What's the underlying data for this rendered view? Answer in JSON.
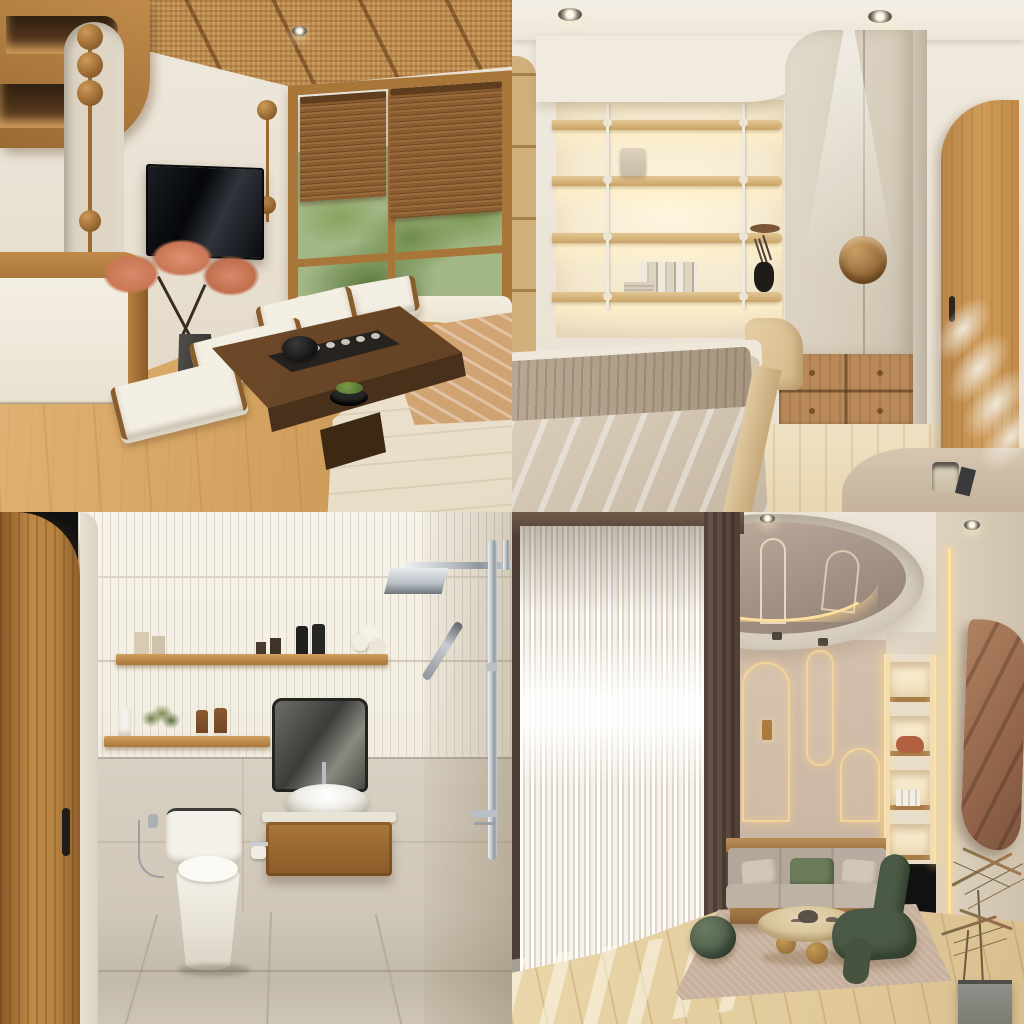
{
  "image": {
    "kind": "interior-design-render-collage",
    "grid": "2x2",
    "style": "Japandi / warm minimalist interiors, beige and wood palette",
    "text_visible": "none"
  },
  "panels": [
    {
      "id": "living-room",
      "position": "top-left",
      "room_type": "Japanese-style living room",
      "description": "Tatami-style tea lounge with rattan ceiling, wall-mounted TV, bamboo blinds over a garden window, low walnut tea table with tea set, floor cushions, cherry-blossom bonsai and white daybed",
      "objects": [
        "rattan ceiling with wood beams",
        "recessed spotlight",
        "wooden wall shelf with warm lighting",
        "white drawer cabinet with wood trim",
        "arched wall niche",
        "wooden bead ornaments",
        "wall-mounted TV",
        "cherry-blossom bonsai in dark vase",
        "wood-framed window",
        "two bamboo roller blinds",
        "greenery and white building outside",
        "low walnut tea table",
        "black teapot and tea cups",
        "moss bowl",
        "floor cushions with wood frames",
        "white daybed",
        "peach throw blanket",
        "oak plank floor"
      ],
      "colors": {
        "wall": "#e9e2d4",
        "wood": "#b5823f",
        "floor": "#d9a968",
        "tv": "#0b0d10",
        "blossom": "#d98a6a"
      }
    },
    {
      "id": "bedroom",
      "position": "top-right",
      "room_type": "bedroom with built-in wardrobe",
      "description": "Cream bedroom with backlit display shelving on thin rods, greige wardrobe with circular wood handle lit by a spotlight, oak drawer chest, arched oak door, pampas grass and a bed with taupe throw",
      "objects": [
        "recessed ceiling spotlights",
        "backlit wooden shelves with white rods",
        "cylinder table lamp",
        "wooden bowl",
        "books",
        "black vase with dried stems",
        "greige two-door wardrobe",
        "circular recessed wood handle",
        "wooden drawer chest with knobs",
        "arched oak door with black handle",
        "pampas grass",
        "bed with beige duvet",
        "taupe throw blanket",
        "curved wood bedside seat",
        "rounded desk with cup",
        "light wood floor"
      ],
      "colors": {
        "wall": "#efe9dd",
        "wardrobe": "#ddd4c4",
        "shelf_glow": "#fff6e0",
        "door": "#c8954f",
        "bedding": "#d9cdbc"
      }
    },
    {
      "id": "bathroom",
      "position": "bottom-left",
      "room_type": "bathroom",
      "description": "Compact bathroom with arched wooden door, white fluted tile upper walls, beige stone lower walls, wooden shelves with toiletries, tinted mirror, vessel sink on floating wood vanity, one-piece toilet and chrome rain shower",
      "objects": [
        "arched wooden door with black handle",
        "white fluted tile walls",
        "beige stone tile walls and floor",
        "upper wooden shelf",
        "lower wooden shelf",
        "toiletry bottles",
        "rolled towels",
        "green plant",
        "tinted square mirror",
        "white vessel sink",
        "chrome faucet",
        "floating wood vanity",
        "one-piece toilet",
        "bidet sprayer",
        "toilet paper holder",
        "chrome rain shower head",
        "handheld shower wand on rail"
      ],
      "colors": {
        "tile": "#f1ecdf",
        "stone": "#d4ccbe",
        "wood": "#a9763a",
        "chrome": "#b9bfc5",
        "sanitary": "#f4f1ea"
      }
    },
    {
      "id": "lounge",
      "position": "bottom-right",
      "room_type": "lounge with arch feature wall",
      "description": "Tall lounge with oval mirrored ceiling dome ringed by LED light, sheer floor-to-ceiling curtains, taupe wall with LED-lit arch niches, illuminated shelves, gray sofa with green cushion, round wood coffee table, green sculptural chair, knot pouf, draped-fabric wall art and potted dracaena",
      "objects": [
        "oval mirrored ceiling dome",
        "LED ring light",
        "recessed spotlights",
        "track spotlights",
        "sheer white curtains",
        "dark curtain panel",
        "taupe arch feature wall",
        "LED-outlined arch niches",
        "wall sconce",
        "illuminated display shelves",
        "vertical LED strips",
        "brown drape wall art",
        "gray three-seat sofa on wood base",
        "beige pillows",
        "green pillow",
        "round wood coffee table with ball feet",
        "tea set",
        "green knot pouf",
        "green sculptural lounge chair",
        "woven rug",
        "dracaena in concrete planter",
        "oak plank floor with light stripes"
      ],
      "colors": {
        "ceiling": "#e9e2d5",
        "feature_wall": "#cdbaa8",
        "led": "#ffe2a0",
        "sofa": "#b6aa9c",
        "chair": "#4b5a46",
        "drape": "#a3795b"
      }
    }
  ],
  "palette": {
    "wall": "#e9e2d4",
    "wall2": "#ded3c0",
    "wood": "#a9763a",
    "wood-dark": "#8a5a28",
    "wood-light": "#d9bc90",
    "walnut": "#5f3f22",
    "floor-a": "#e2b577",
    "floor-b": "#c6924f",
    "rattan": "#c89a5e",
    "blind": "#8a5c30",
    "leaf": "#7c8f56",
    "tv": "#0b0d10",
    "greige": "#ddd4c4",
    "bedding": "#d9cdbc",
    "throw": "#b0a08e",
    "flute": "#f1ecdf",
    "flute-line": "#ddd6c8",
    "marble": "#d4ccbe",
    "chrome-a": "#eef1f3",
    "chrome-b": "#8f969c",
    "taupe": "#cdbaa8",
    "sheer": "#f1ebe0",
    "curtain-dark": "#55443a",
    "led": "#ffe2a0",
    "sofa": "#b6aa9c",
    "cushion-green": "#6c7c5b",
    "chair-green": "#4b5a46",
    "drape": "#a3795b",
    "rug": "#c7b09d",
    "lounge-floor": "#e7d3a6",
    "planter": "#8d8c86"
  }
}
